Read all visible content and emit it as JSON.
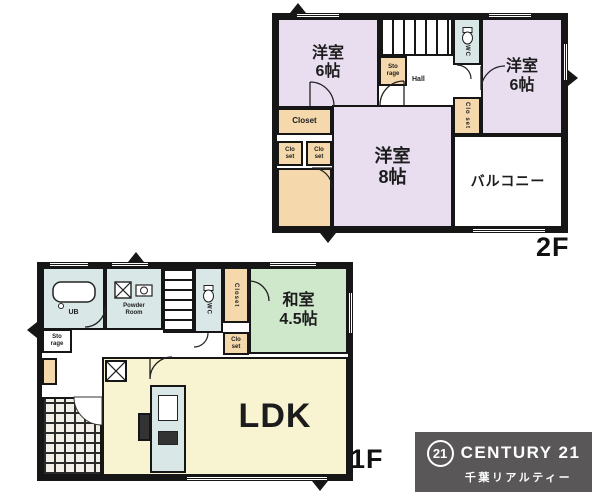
{
  "palette": {
    "wall": "#161616",
    "western_room": "#e8def0",
    "tatami_room": "#cfe8cc",
    "ldk_room": "#f8f3d0",
    "closet": "#f5d9ad",
    "wet_area": "#d9e8e7",
    "logo_bg": "#595757",
    "logo_text": "#ffffff"
  },
  "floor2": {
    "floor_label": "2F",
    "room_nw_name": "洋室",
    "room_nw_size": "6帖",
    "room_e_name": "洋室",
    "room_e_size": "6帖",
    "room_s_name": "洋室",
    "room_s_size": "8帖",
    "balcony_label": "バルコニー",
    "closet_label": "Closet",
    "closet_small_1": "Clo set",
    "closet_small_2": "Clo set",
    "storage_label": "Sto rage",
    "hall_label": "Hall",
    "wc_label": "WC"
  },
  "floor1": {
    "floor_label": "1F",
    "ldk_label": "LDK",
    "washitsu_name": "和室",
    "washitsu_size": "4.5帖",
    "bath_label": "UB",
    "powder_label": "Powder Room",
    "wc_label": "WC",
    "closet_v_label": "Closet",
    "closet_small": "Clo set",
    "storage_label": "Sto rage"
  },
  "logo": {
    "badge": "21",
    "brand": "CENTURY 21",
    "subtitle": "千葉リアルティー"
  }
}
